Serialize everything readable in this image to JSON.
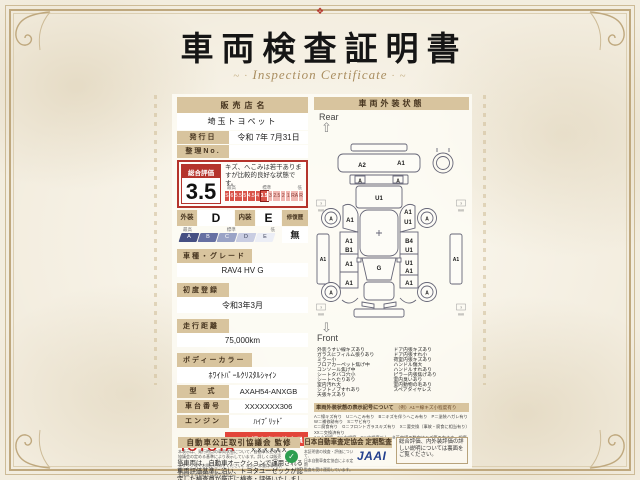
{
  "certificate": {
    "crest_glyph": "❖",
    "title": "車両検査証明書",
    "subtitle": "Inspection Certificate",
    "dealer": {
      "label": "販売店名",
      "name": "埼玉トヨペット"
    },
    "issue": {
      "label": "発行日",
      "value": "令和 7年 7月31日"
    },
    "ref_no": {
      "label": "整理No.",
      "value": ""
    },
    "overall": {
      "label": "総合評価",
      "score": "3.5",
      "comment": "キズ、へこみは若干ありますが比較的良好な状態です。",
      "scale_labels": {
        "high": "最高",
        "mid": "標準",
        "low": "低"
      },
      "scale": [
        "S",
        "6",
        "5.5",
        "5",
        "4.5",
        "4",
        "3.5",
        "3",
        "2.5",
        "2",
        "1",
        "RA",
        "R"
      ],
      "highlight": "3.5"
    },
    "exterior_grade": {
      "label": "外装",
      "value": "D"
    },
    "interior_grade": {
      "label": "内装",
      "value": "E"
    },
    "repair_history": {
      "label": "修復歴",
      "value": "無"
    },
    "grade_scale": {
      "labels": {
        "high": "最高",
        "mid": "標準",
        "low": "低"
      },
      "steps": [
        "A",
        "B",
        "C",
        "D",
        "E"
      ],
      "colors": [
        "#454f82",
        "#6670a2",
        "#9aa3c6",
        "#c9cde2",
        "#eceef6"
      ]
    },
    "fields": [
      {
        "label": "車種・グレード",
        "value": "RAV4 HV G"
      },
      {
        "label": "初度登録",
        "value": "令和3年3月"
      },
      {
        "label": "走行距離",
        "value": "75,000km"
      },
      {
        "label": "ボディーカラー",
        "value": "ﾎﾜｲﾄﾊﾟｰﾙｸﾘｽﾀﾙｼｬｲﾝ"
      }
    ],
    "inline_fields": [
      {
        "label": "型　式",
        "value": "AXAH54-ANXGB"
      },
      {
        "label": "車台番号",
        "value": "XXXXXXX306"
      },
      {
        "label": "エンジン",
        "value": "ﾊｲﾌﾞﾘｯﾄﾞ"
      }
    ],
    "inspector": {
      "brand": "TOYOTA",
      "badge": "トヨタ認定車両検査員",
      "id": "XXXXXX"
    },
    "disclaimer": "当車両は、自動車オークションで運用される車両評価基準に沿い、トヨタユーゼックが認定した検査員が厳正に検査・評価いたしました。"
  },
  "exterior": {
    "header": "車両外装状態",
    "rear_label": "Rear",
    "front_label": "Front",
    "rear_arrow_icon": "⇧",
    "front_arrow_icon": "⇩",
    "tread_mark": "?",
    "tread_unit": "mm",
    "marks": [
      {
        "label": "A2",
        "area": "rear-bumper-left"
      },
      {
        "label": "A1",
        "area": "rear-bumper-right"
      },
      {
        "label": "A",
        "area": "rear-gate-left"
      },
      {
        "label": "A",
        "area": "rear-gate-right"
      },
      {
        "label": "U1",
        "area": "tailgate"
      },
      {
        "label": "A",
        "area": "rear-left-wheel"
      },
      {
        "label": "A",
        "area": "rear-right-wheel"
      },
      {
        "label": "A1",
        "area": "left-quarter-panel"
      },
      {
        "label": "A1",
        "area": "right-quarter-panel"
      },
      {
        "label": "U1",
        "area": "right-quarter-lower"
      },
      {
        "label": "A1",
        "area": "left-side-sill"
      },
      {
        "label": "A1",
        "area": "right-side-sill"
      },
      {
        "label": "A1",
        "area": "left-rear-door-upper"
      },
      {
        "label": "B1",
        "area": "left-rear-door-lower"
      },
      {
        "label": "A1",
        "area": "left-front-door"
      },
      {
        "label": "B4",
        "area": "right-rear-door-upper"
      },
      {
        "label": "U1",
        "area": "right-rear-door-lower"
      },
      {
        "label": "U1",
        "area": "right-front-door-upper"
      },
      {
        "label": "A1",
        "area": "right-front-door-lower"
      },
      {
        "label": "A1",
        "area": "left-front-fender"
      },
      {
        "label": "A1",
        "area": "right-front-fender"
      },
      {
        "label": "G",
        "area": "windshield"
      },
      {
        "label": "A",
        "area": "front-left-wheel"
      },
      {
        "label": "A",
        "area": "front-right-wheel"
      }
    ],
    "notes_left": [
      "外装うすい線キズあり",
      "ガラスにフィルム張りあり",
      "ミラー小",
      "フロアカーペット焦げ中",
      "コンソール焦げ中",
      "シートタバコ穴小",
      "シートへたりあり",
      "室内汚れ大",
      "シフトノブすれあり",
      "天張キズあり"
    ],
    "notes_right": [
      "ドア内張キズあり",
      "ドア内張すれ小",
      "荷室内張キズあり",
      "ハンドル傷大",
      "ハンドルすれあり",
      "ピラー内張焦げあり",
      "室内臭いあり",
      "室内動物の毛あり",
      "スペアタイヤレス"
    ],
    "legend_title": "車両外装状態の表示記号について",
    "legend_example": "（例）A1＝線キズ小程度有り",
    "legend_lines": [
      "A＝線キズ有り　U＝へこみ有り　B＝キズを伴うへこみ有り　P＝塗装ハガレ有り　W＝補修跡有り　S＝サビ有り",
      "C＝腐食有り　G＝フロントガラスキズ有り　X＝要交換（事故・腐食に相当有り）　XX＝交換済有り",
      "1＝小程度　2＝中程度　3＝中程度以上　※英字横の数字はキズ等の大きさ・程度を表しています。"
    ]
  },
  "footer": {
    "left_bar": "自動車公正取引協議会 監修",
    "left_note_lines": [
      "本表示は、発行時点の車両状態について、自動車公正取引",
      "協議会の定める基準により表示しています。詳しくは販売店",
      "スタッフまでお問い合わせください。なお、本書は車両状態",
      "を保証するものではありません。"
    ],
    "seal_glyph": "✓",
    "right_bar": "日本自動車査定協会 定期監査",
    "right_note_lines": [
      "本証明書の検査・評価について、",
      "日本自動車査定協会による定期",
      "監査を受け運用しています。"
    ],
    "jaai_logo": "JAAI",
    "info_box": "総合評価、内外装評価の詳しい説明については裏面をご覧ください。"
  },
  "colors": {
    "accent_red": "#b5342c",
    "bar_tan": "#d8c49e",
    "toyota_red": "#d01818",
    "badge_red": "#e2453a",
    "jaai_blue": "#23408e",
    "seal_green": "#2e9e4f"
  }
}
